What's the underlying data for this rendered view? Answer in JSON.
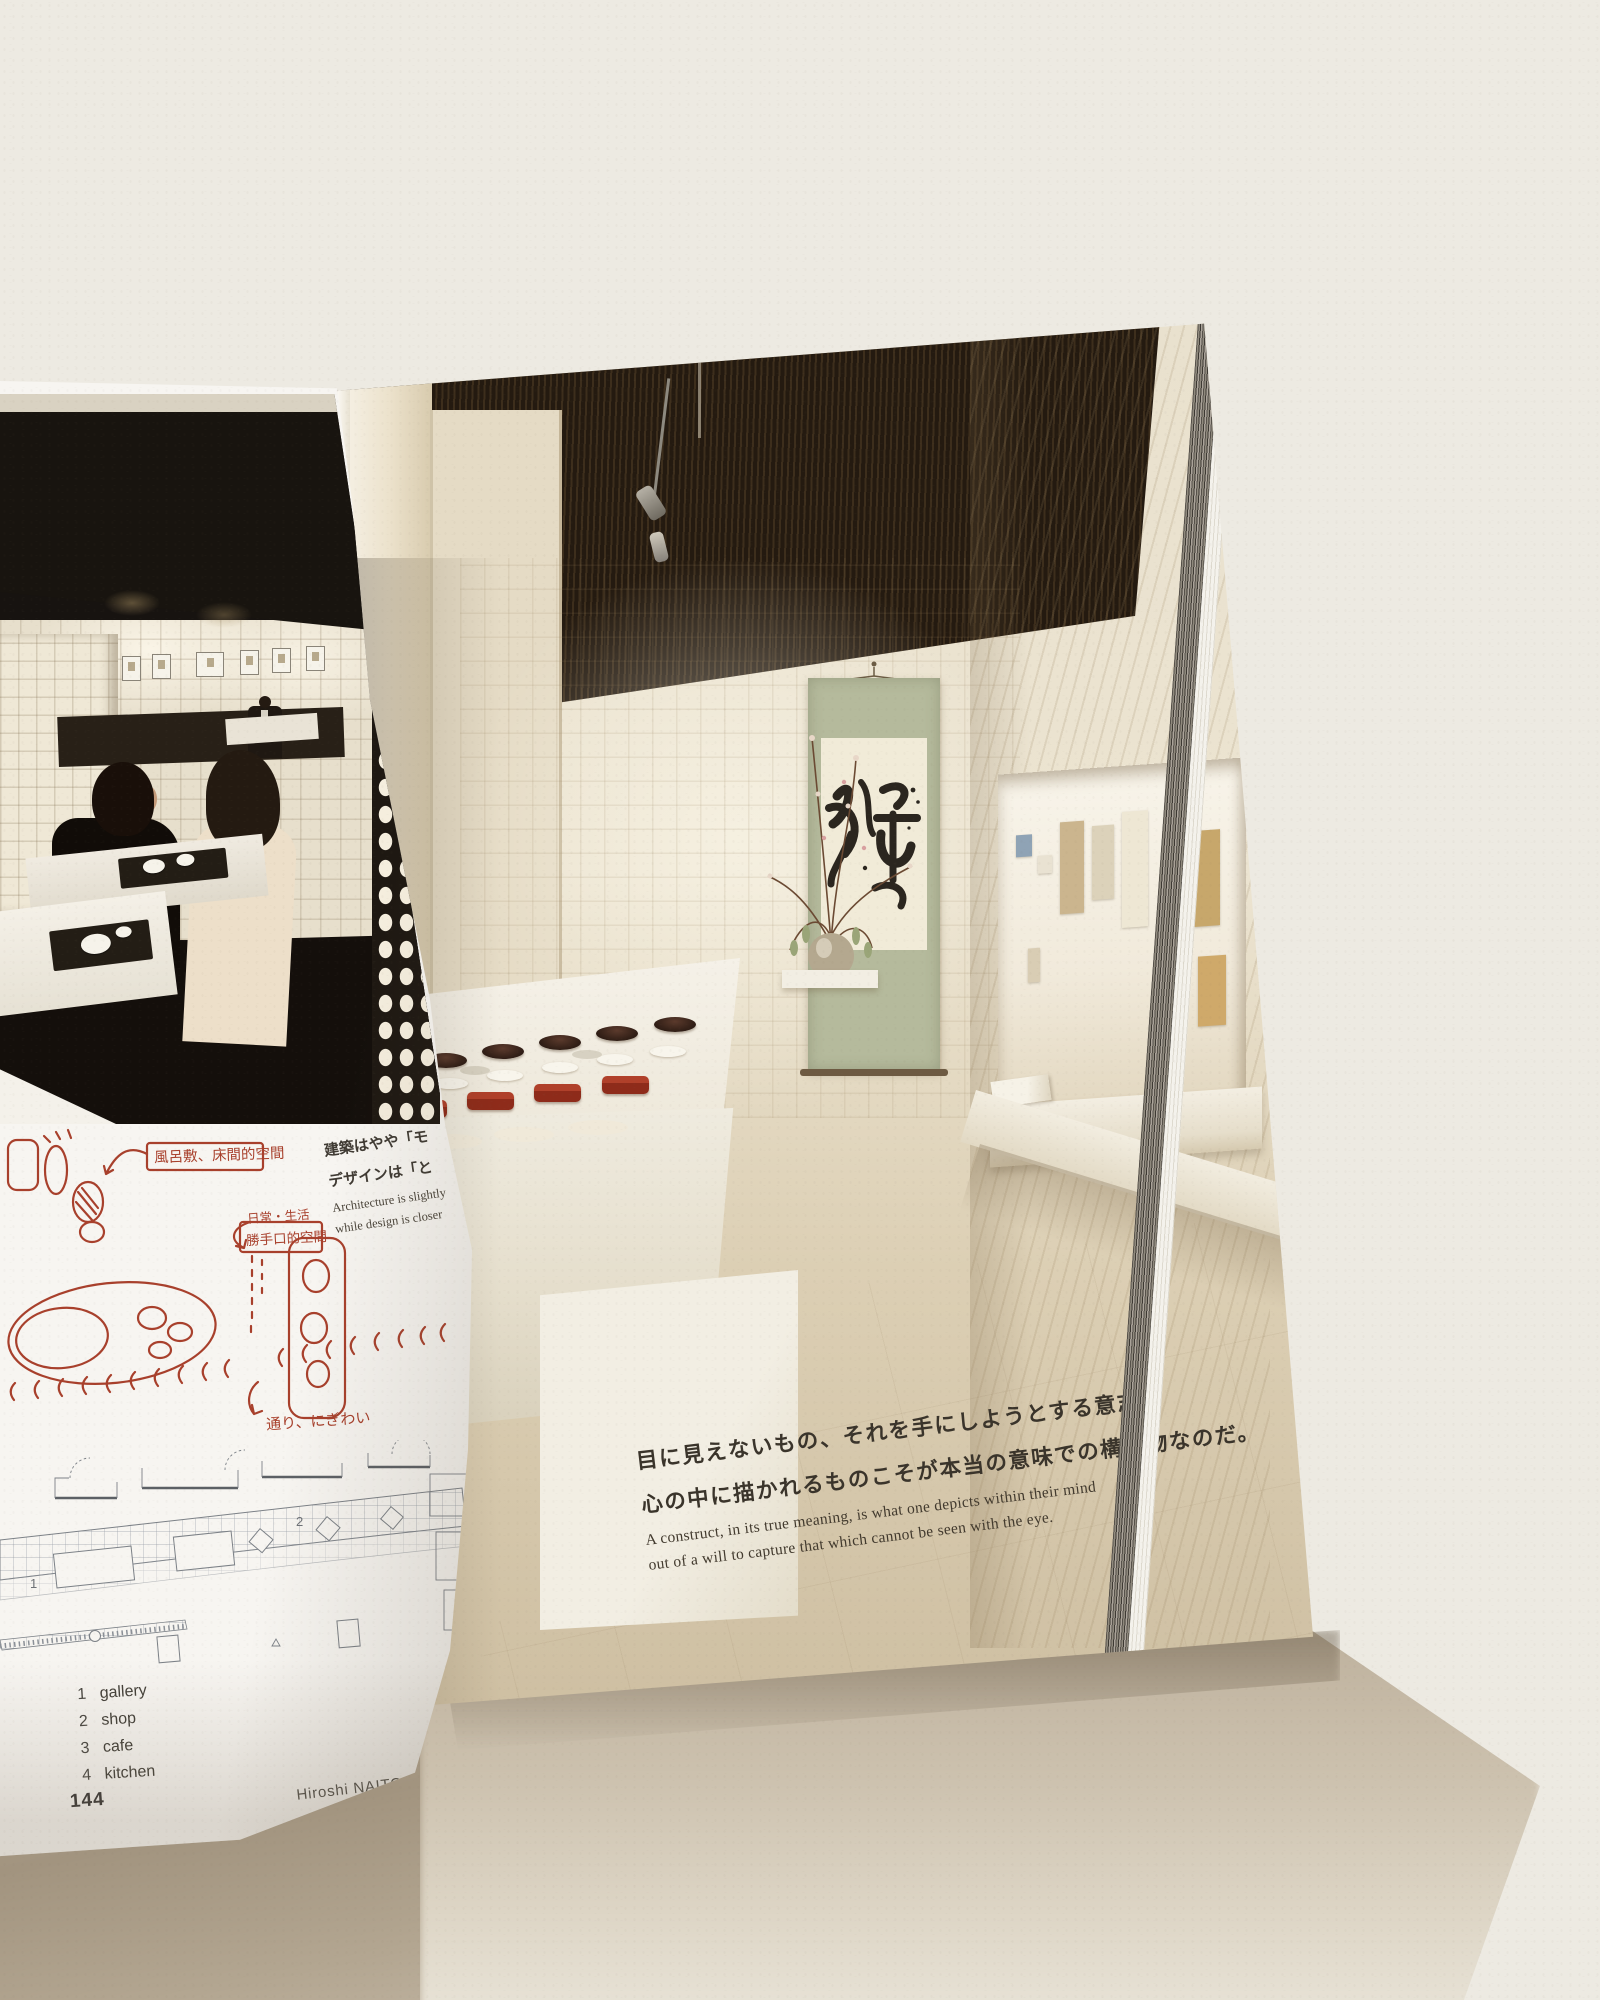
{
  "book": {
    "left_page": {
      "sketch": {
        "annotation_top": "風呂敷、床間的空間",
        "annotation_mid_line1": "日常・生活",
        "annotation_mid_line2": "勝手口的空間",
        "annotation_bottom": "通り、にぎわい"
      },
      "caption": {
        "jp_line1": "建築はやや「モ",
        "jp_line2": "デザインは「と",
        "en_line1": "Architecture is slightly",
        "en_line2": "while design is closer"
      },
      "plan": {
        "label_room1": "1",
        "label_room2": "2"
      },
      "legend": {
        "items": [
          {
            "num": "1",
            "label": "gallery"
          },
          {
            "num": "2",
            "label": "shop"
          },
          {
            "num": "3",
            "label": "cafe"
          },
          {
            "num": "4",
            "label": "kitchen"
          }
        ]
      },
      "page_number": "144",
      "credit": "Hiroshi NAITO  2005-2013"
    },
    "right_page": {
      "caption": {
        "jp_line1": "目に見えないもの、それを手にしようとする意志、",
        "jp_line2": "心の中に描かれるものこそが本当の意味での構築物なのだ。",
        "en_line1": "A construct, in its true meaning, is what one depicts within their mind",
        "en_line2": "out of a will to capture that which cannot be seen with the eye."
      },
      "niche_calligraphy": "夜の梅"
    }
  },
  "colors": {
    "background": "#edeae2",
    "red_ink": "#a8402c",
    "scroll_green": "#b5ba9c",
    "lacquer_red": "#8e2b1a",
    "plan_line": "#7c8187"
  }
}
